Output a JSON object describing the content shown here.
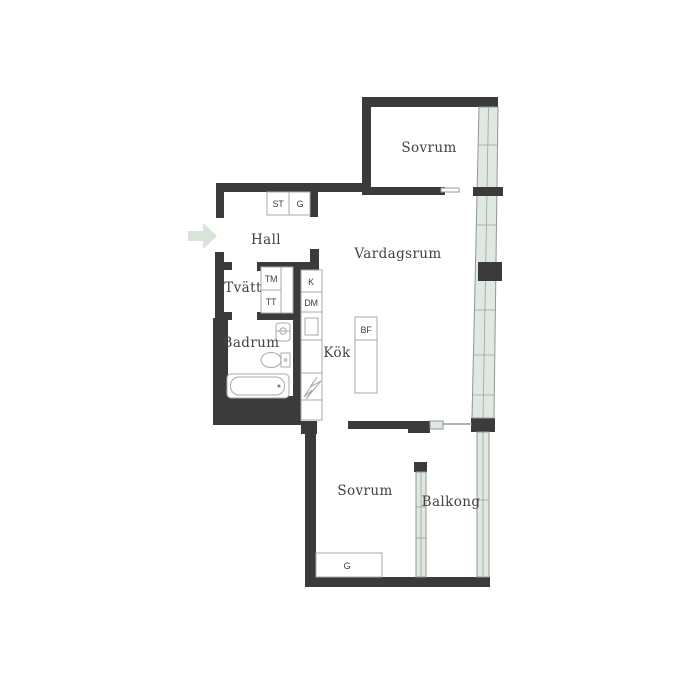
{
  "plan": {
    "type": "apartment-floor-plan",
    "language": "Swedish"
  },
  "colors": {
    "wall": "#3b3b3b",
    "window_fill": "#dfe8e1",
    "window_frame": "#8f9795",
    "fixture_outline": "#a9a9a9",
    "label_text": "#414141",
    "entry_arrow": "#d8e4d8",
    "background": "#ffffff"
  },
  "rooms": [
    {
      "id": "sovrum-top",
      "label": "Sovrum"
    },
    {
      "id": "vardagsrum",
      "label": "Vardagsrum"
    },
    {
      "id": "hall",
      "label": "Hall"
    },
    {
      "id": "tvatt",
      "label": "Tvätt"
    },
    {
      "id": "badrum",
      "label": "Badrum"
    },
    {
      "id": "kok",
      "label": "Kök"
    },
    {
      "id": "sovrum-bottom",
      "label": "Sovrum"
    },
    {
      "id": "balkong",
      "label": "Balkong"
    }
  ],
  "fixtures": {
    "hall_closet_1": "ST",
    "hall_closet_2": "G",
    "washing_machine": "TM",
    "tumble_dryer": "TT",
    "kitchen_unit_k": "K",
    "dishwasher": "DM",
    "kitchen_island": "BF",
    "bedroom_closet": "G"
  },
  "icons": {
    "entrance_arrow": "right-arrow"
  }
}
